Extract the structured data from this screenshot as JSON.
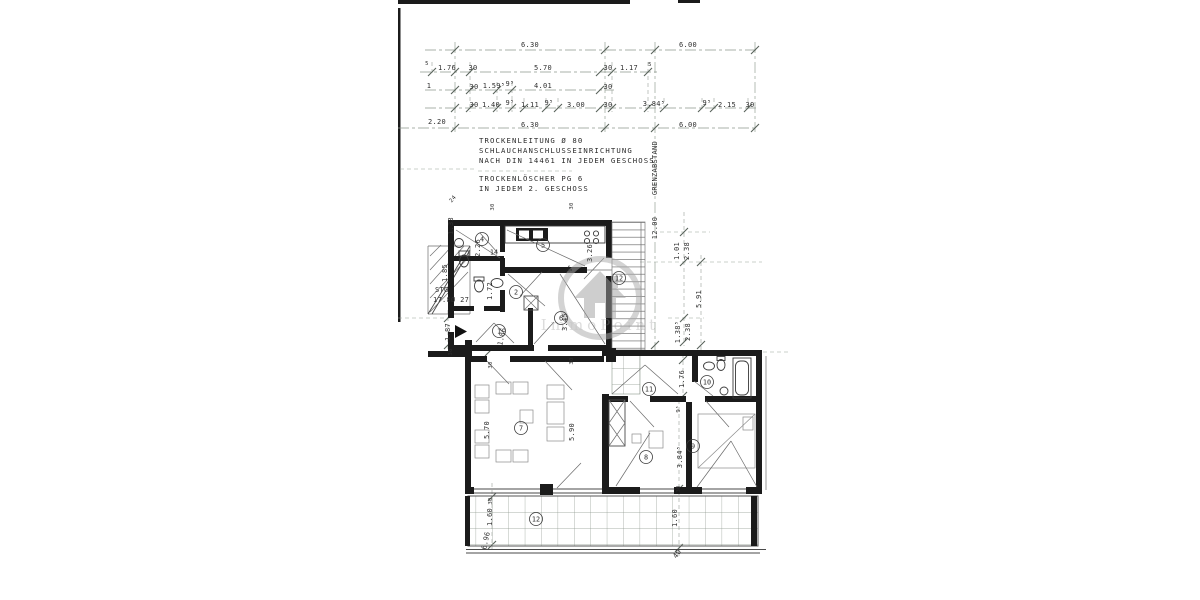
{
  "watermark": {
    "brand": "ImmoPoint"
  },
  "colors": {
    "wall": "#1b1b1b",
    "dimension_line": "#8f998f",
    "watermark_gray": "#9e9e9e",
    "paper": "#ffffff"
  },
  "annotations": {
    "trockenleitung": [
      "TROCKENLEITUNG Ø 80",
      "SCHLAUCHANSCHLUSSEINRICHTUNG",
      "NACH DIN 14461 IN JEDEM GESCHOSS"
    ],
    "trockenloescher": [
      "TROCKENLÖSCHER PG 6",
      "IN JEDEM 2. GESCHOSS"
    ],
    "grenzabstand_label": "GRENZABSTAND",
    "grenzabstand_value": "12.00",
    "stairs_label": "STG",
    "stairs_value": "17.8Ø 27"
  },
  "room_labels": [
    {
      "n": "4",
      "x": 482,
      "y": 239,
      "c": 1
    },
    {
      "n": "14",
      "x": 494,
      "y": 252,
      "c": 0
    },
    {
      "n": "5",
      "x": 543,
      "y": 245,
      "c": 1
    },
    {
      "n": "2",
      "x": 516,
      "y": 292,
      "c": 1
    },
    {
      "n": "6",
      "x": 561,
      "y": 318,
      "c": 1
    },
    {
      "n": "1",
      "x": 499,
      "y": 331,
      "c": 1
    },
    {
      "n": "12",
      "x": 619,
      "y": 278,
      "c": 1
    },
    {
      "n": "7",
      "x": 521,
      "y": 428,
      "c": 1
    },
    {
      "n": "11",
      "x": 649,
      "y": 389,
      "c": 1
    },
    {
      "n": "10",
      "x": 707,
      "y": 382,
      "c": 1
    },
    {
      "n": "8",
      "x": 646,
      "y": 457,
      "c": 1
    },
    {
      "n": "9",
      "x": 693,
      "y": 446,
      "c": 1
    },
    {
      "n": "12",
      "x": 536,
      "y": 519,
      "c": 1
    }
  ],
  "dim_labels": [
    {
      "t": "6.30",
      "x": 530,
      "y": 47
    },
    {
      "t": "6.00",
      "x": 688,
      "y": 47
    },
    {
      "t": "5",
      "x": 427,
      "y": 65,
      "s": 1
    },
    {
      "t": "1.76",
      "x": 447,
      "y": 70
    },
    {
      "t": "30",
      "x": 473,
      "y": 70
    },
    {
      "t": "5.70",
      "x": 543,
      "y": 70
    },
    {
      "t": "30",
      "x": 608,
      "y": 70
    },
    {
      "t": "1.17",
      "x": 629,
      "y": 70
    },
    {
      "t": "5",
      "x": 650,
      "y": 66,
      "s": 1
    },
    {
      "t": "1",
      "x": 429,
      "y": 88
    },
    {
      "t": "30",
      "x": 474,
      "y": 89
    },
    {
      "t": "1.59⁵",
      "x": 494,
      "y": 88
    },
    {
      "t": "9⁵",
      "x": 510,
      "y": 86
    },
    {
      "t": "4.01",
      "x": 543,
      "y": 88
    },
    {
      "t": "30",
      "x": 608,
      "y": 89
    },
    {
      "t": "30",
      "x": 474,
      "y": 107
    },
    {
      "t": "1.40",
      "x": 491,
      "y": 107
    },
    {
      "t": "9⁵",
      "x": 510,
      "y": 105
    },
    {
      "t": "1.11",
      "x": 530,
      "y": 107
    },
    {
      "t": "9⁵",
      "x": 549,
      "y": 105
    },
    {
      "t": "3.00",
      "x": 576,
      "y": 107
    },
    {
      "t": "30",
      "x": 608,
      "y": 107
    },
    {
      "t": "3.84⁵",
      "x": 654,
      "y": 106
    },
    {
      "t": "9⁵",
      "x": 707,
      "y": 105
    },
    {
      "t": "2.15",
      "x": 727,
      "y": 107
    },
    {
      "t": "30",
      "x": 750,
      "y": 107
    },
    {
      "t": "2.20",
      "x": 437,
      "y": 124
    },
    {
      "t": "6.30",
      "x": 530,
      "y": 127
    },
    {
      "t": "6.00",
      "x": 688,
      "y": 127
    },
    {
      "t": "24",
      "x": 454,
      "y": 200,
      "r": -50,
      "s": 1
    },
    {
      "t": "30",
      "x": 494,
      "y": 207,
      "r": -90,
      "s": 1
    },
    {
      "t": "30",
      "x": 573,
      "y": 206,
      "r": -90,
      "s": 1
    },
    {
      "t": "1.33",
      "x": 453,
      "y": 226,
      "r": -90
    },
    {
      "t": "2.26",
      "x": 480,
      "y": 248,
      "r": -90
    },
    {
      "t": "3.26",
      "x": 592,
      "y": 253,
      "r": -90
    },
    {
      "t": "1.85",
      "x": 447,
      "y": 273,
      "r": -90
    },
    {
      "t": "1.72",
      "x": 492,
      "y": 291,
      "r": -90
    },
    {
      "t": "9⁵",
      "x": 572,
      "y": 268,
      "r": -90,
      "s": 1
    },
    {
      "t": "1.87",
      "x": 450,
      "y": 332,
      "r": -90
    },
    {
      "t": "1.86",
      "x": 504,
      "y": 337,
      "r": -78
    },
    {
      "t": "3.45",
      "x": 567,
      "y": 322,
      "r": -90
    },
    {
      "t": "30",
      "x": 452,
      "y": 352,
      "r": -90,
      "s": 1
    },
    {
      "t": "1.01",
      "x": 679,
      "y": 251,
      "r": -90
    },
    {
      "t": "2.38",
      "x": 689,
      "y": 251,
      "r": -90
    },
    {
      "t": "5.91",
      "x": 701,
      "y": 299,
      "r": -90
    },
    {
      "t": "1.38⁵",
      "x": 680,
      "y": 332,
      "r": -90
    },
    {
      "t": "2.38",
      "x": 690,
      "y": 332,
      "r": -90
    },
    {
      "t": "30",
      "x": 492,
      "y": 365,
      "r": -90,
      "s": 1
    },
    {
      "t": "30",
      "x": 573,
      "y": 361,
      "r": -90,
      "s": 1
    },
    {
      "t": "5.70",
      "x": 489,
      "y": 430,
      "r": -90
    },
    {
      "t": "5.90",
      "x": 574,
      "y": 432,
      "r": -90
    },
    {
      "t": "1.76",
      "x": 684,
      "y": 379,
      "r": -90
    },
    {
      "t": "9⁵",
      "x": 680,
      "y": 409,
      "r": -90,
      "s": 1
    },
    {
      "t": "3.84⁵",
      "x": 682,
      "y": 457,
      "r": -90
    },
    {
      "t": "30",
      "x": 680,
      "y": 489,
      "r": -90,
      "s": 1
    },
    {
      "t": "30",
      "x": 492,
      "y": 501,
      "r": -90,
      "s": 1
    },
    {
      "t": "1.60",
      "x": 492,
      "y": 517,
      "r": -90
    },
    {
      "t": "1.60",
      "x": 677,
      "y": 518,
      "r": -90
    },
    {
      "t": "6.96",
      "x": 488,
      "y": 541,
      "r": -78
    },
    {
      "t": "40",
      "x": 679,
      "y": 555,
      "r": -55
    }
  ]
}
